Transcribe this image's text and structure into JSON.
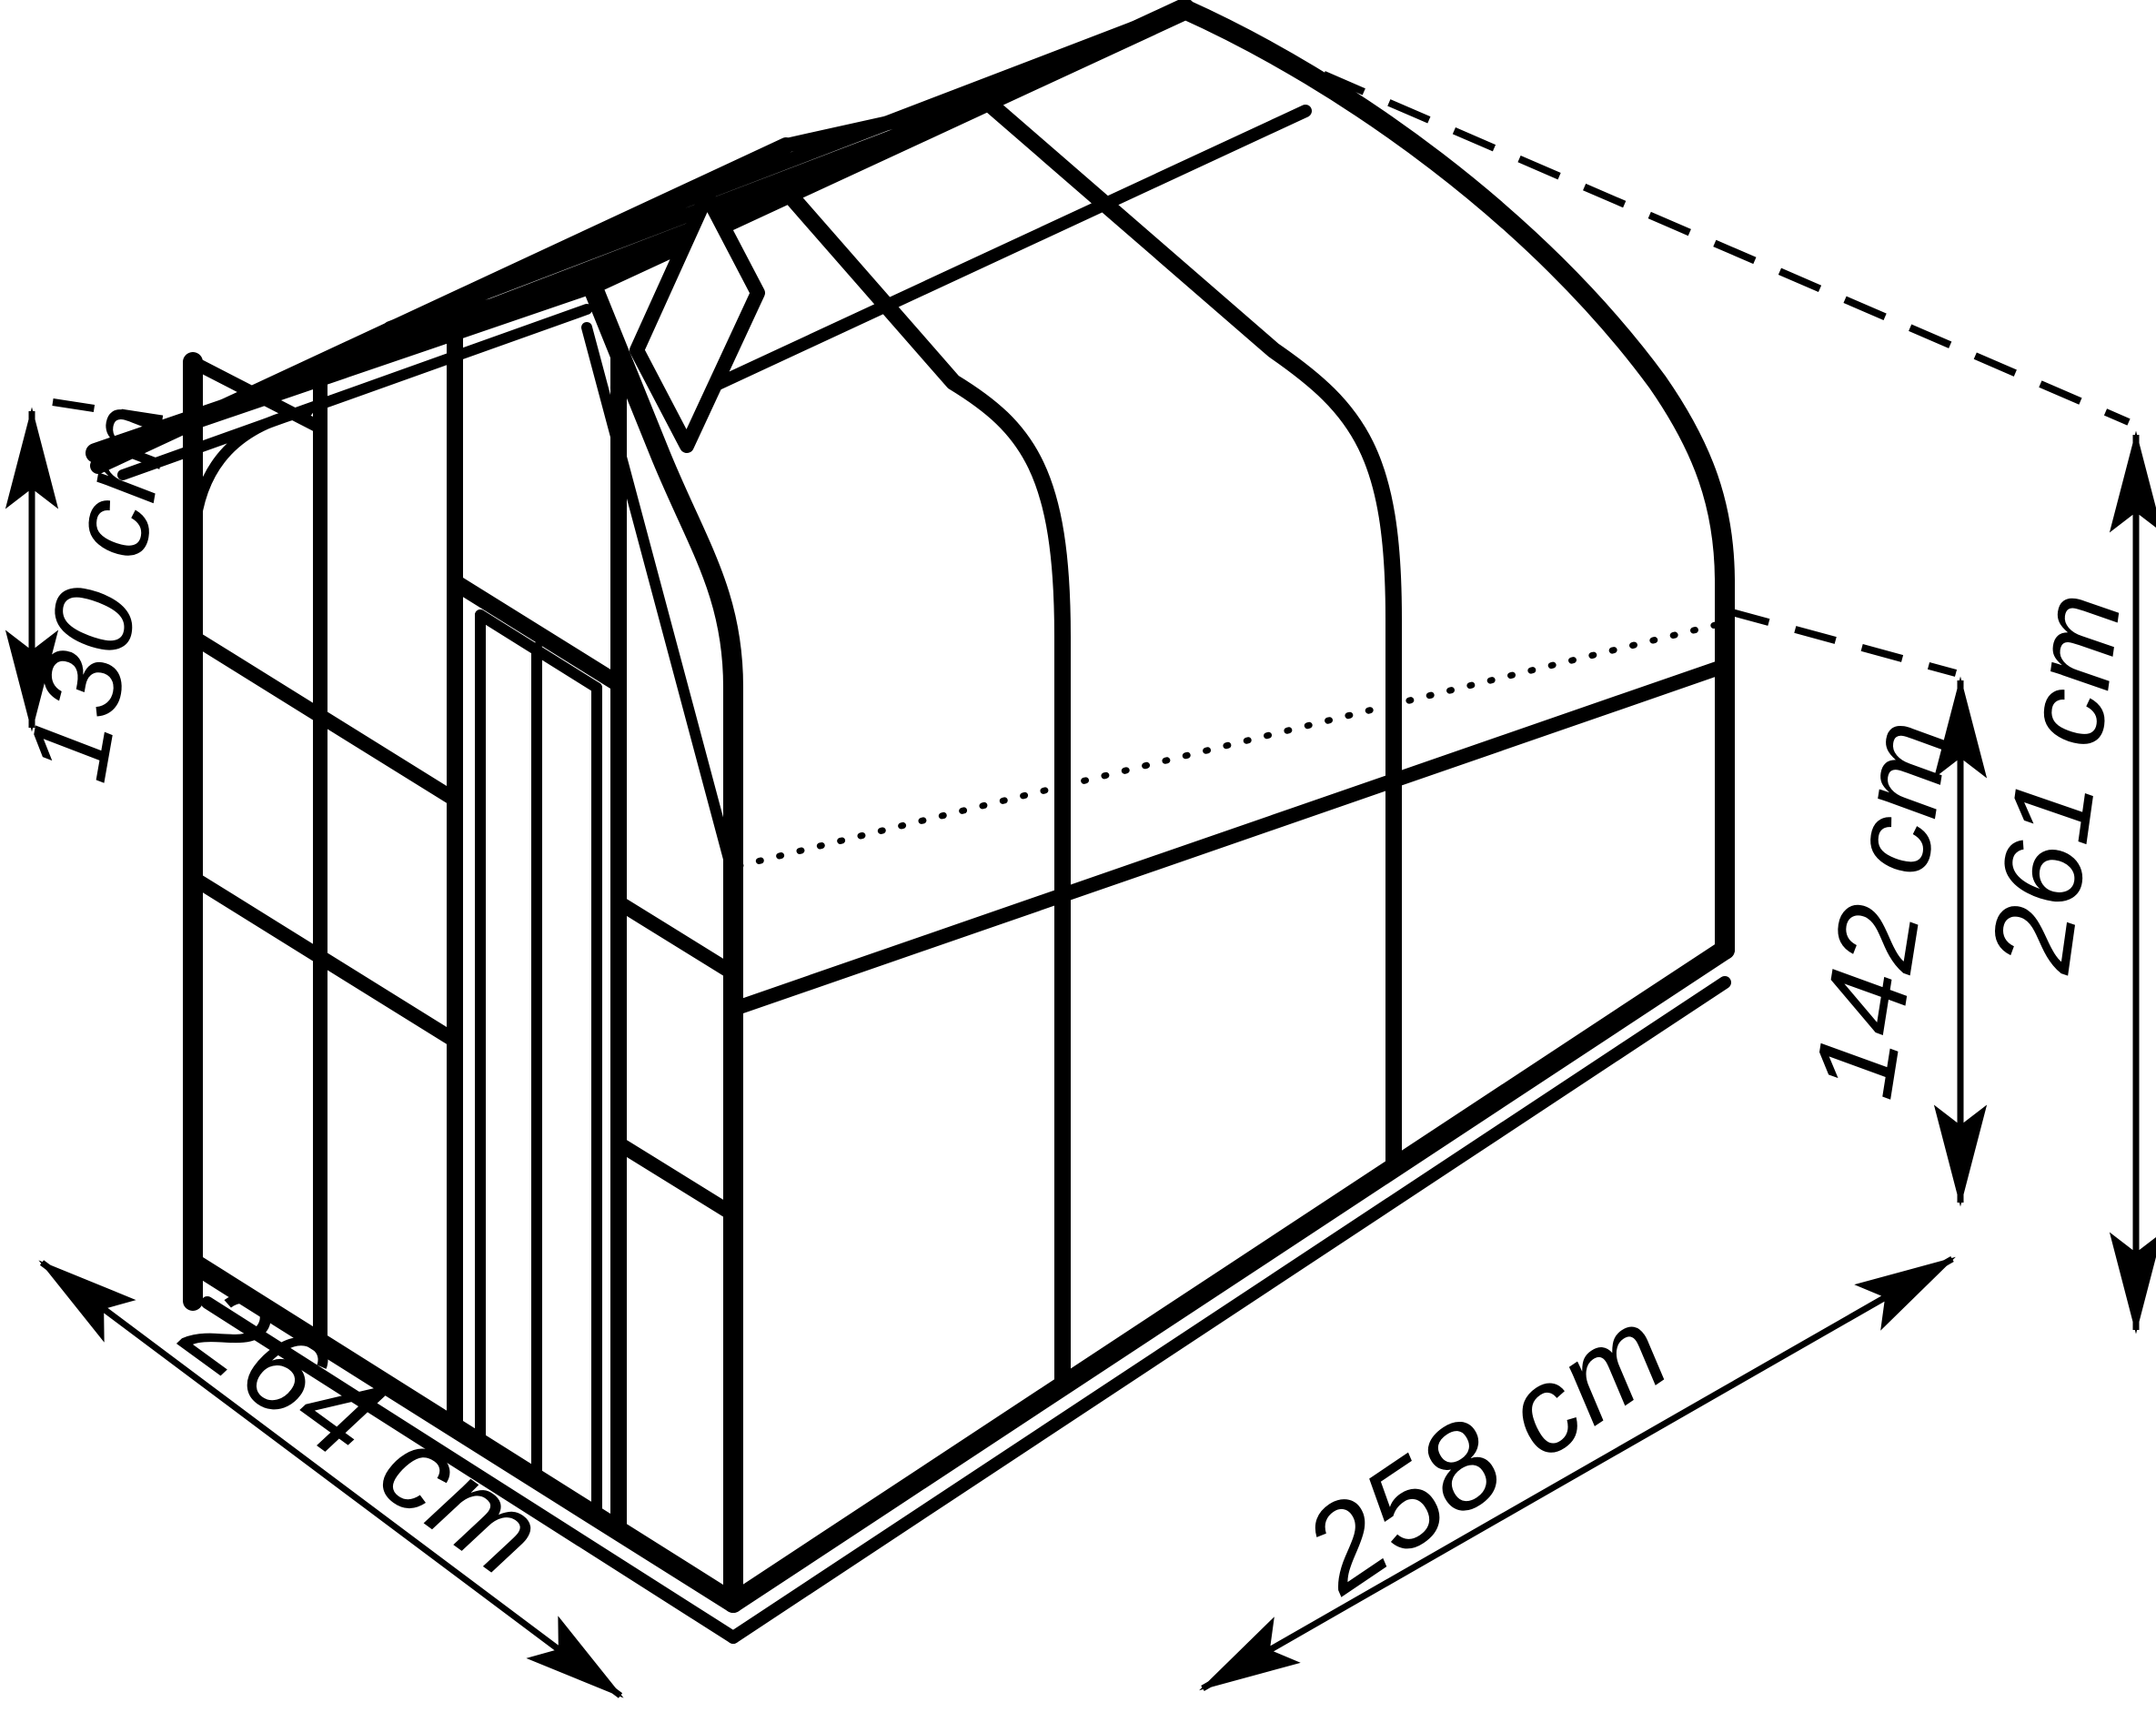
{
  "diagram": {
    "object": "greenhouse-isometric-wireframe",
    "background_color": "#ffffff",
    "line_color": "#000000",
    "unit": "cm",
    "dimensions": {
      "left_height": {
        "id": "left-height",
        "label": "130 cm",
        "value": 130
      },
      "left_base": {
        "id": "depth",
        "label": "264 cm",
        "value": 264
      },
      "right_base": {
        "id": "width",
        "label": "258 cm",
        "value": 258
      },
      "eave_height": {
        "id": "eave-height",
        "label": "142 cm",
        "value": 142
      },
      "ridge_height": {
        "id": "ridge-height",
        "label": "261 cm",
        "value": 261
      }
    }
  }
}
